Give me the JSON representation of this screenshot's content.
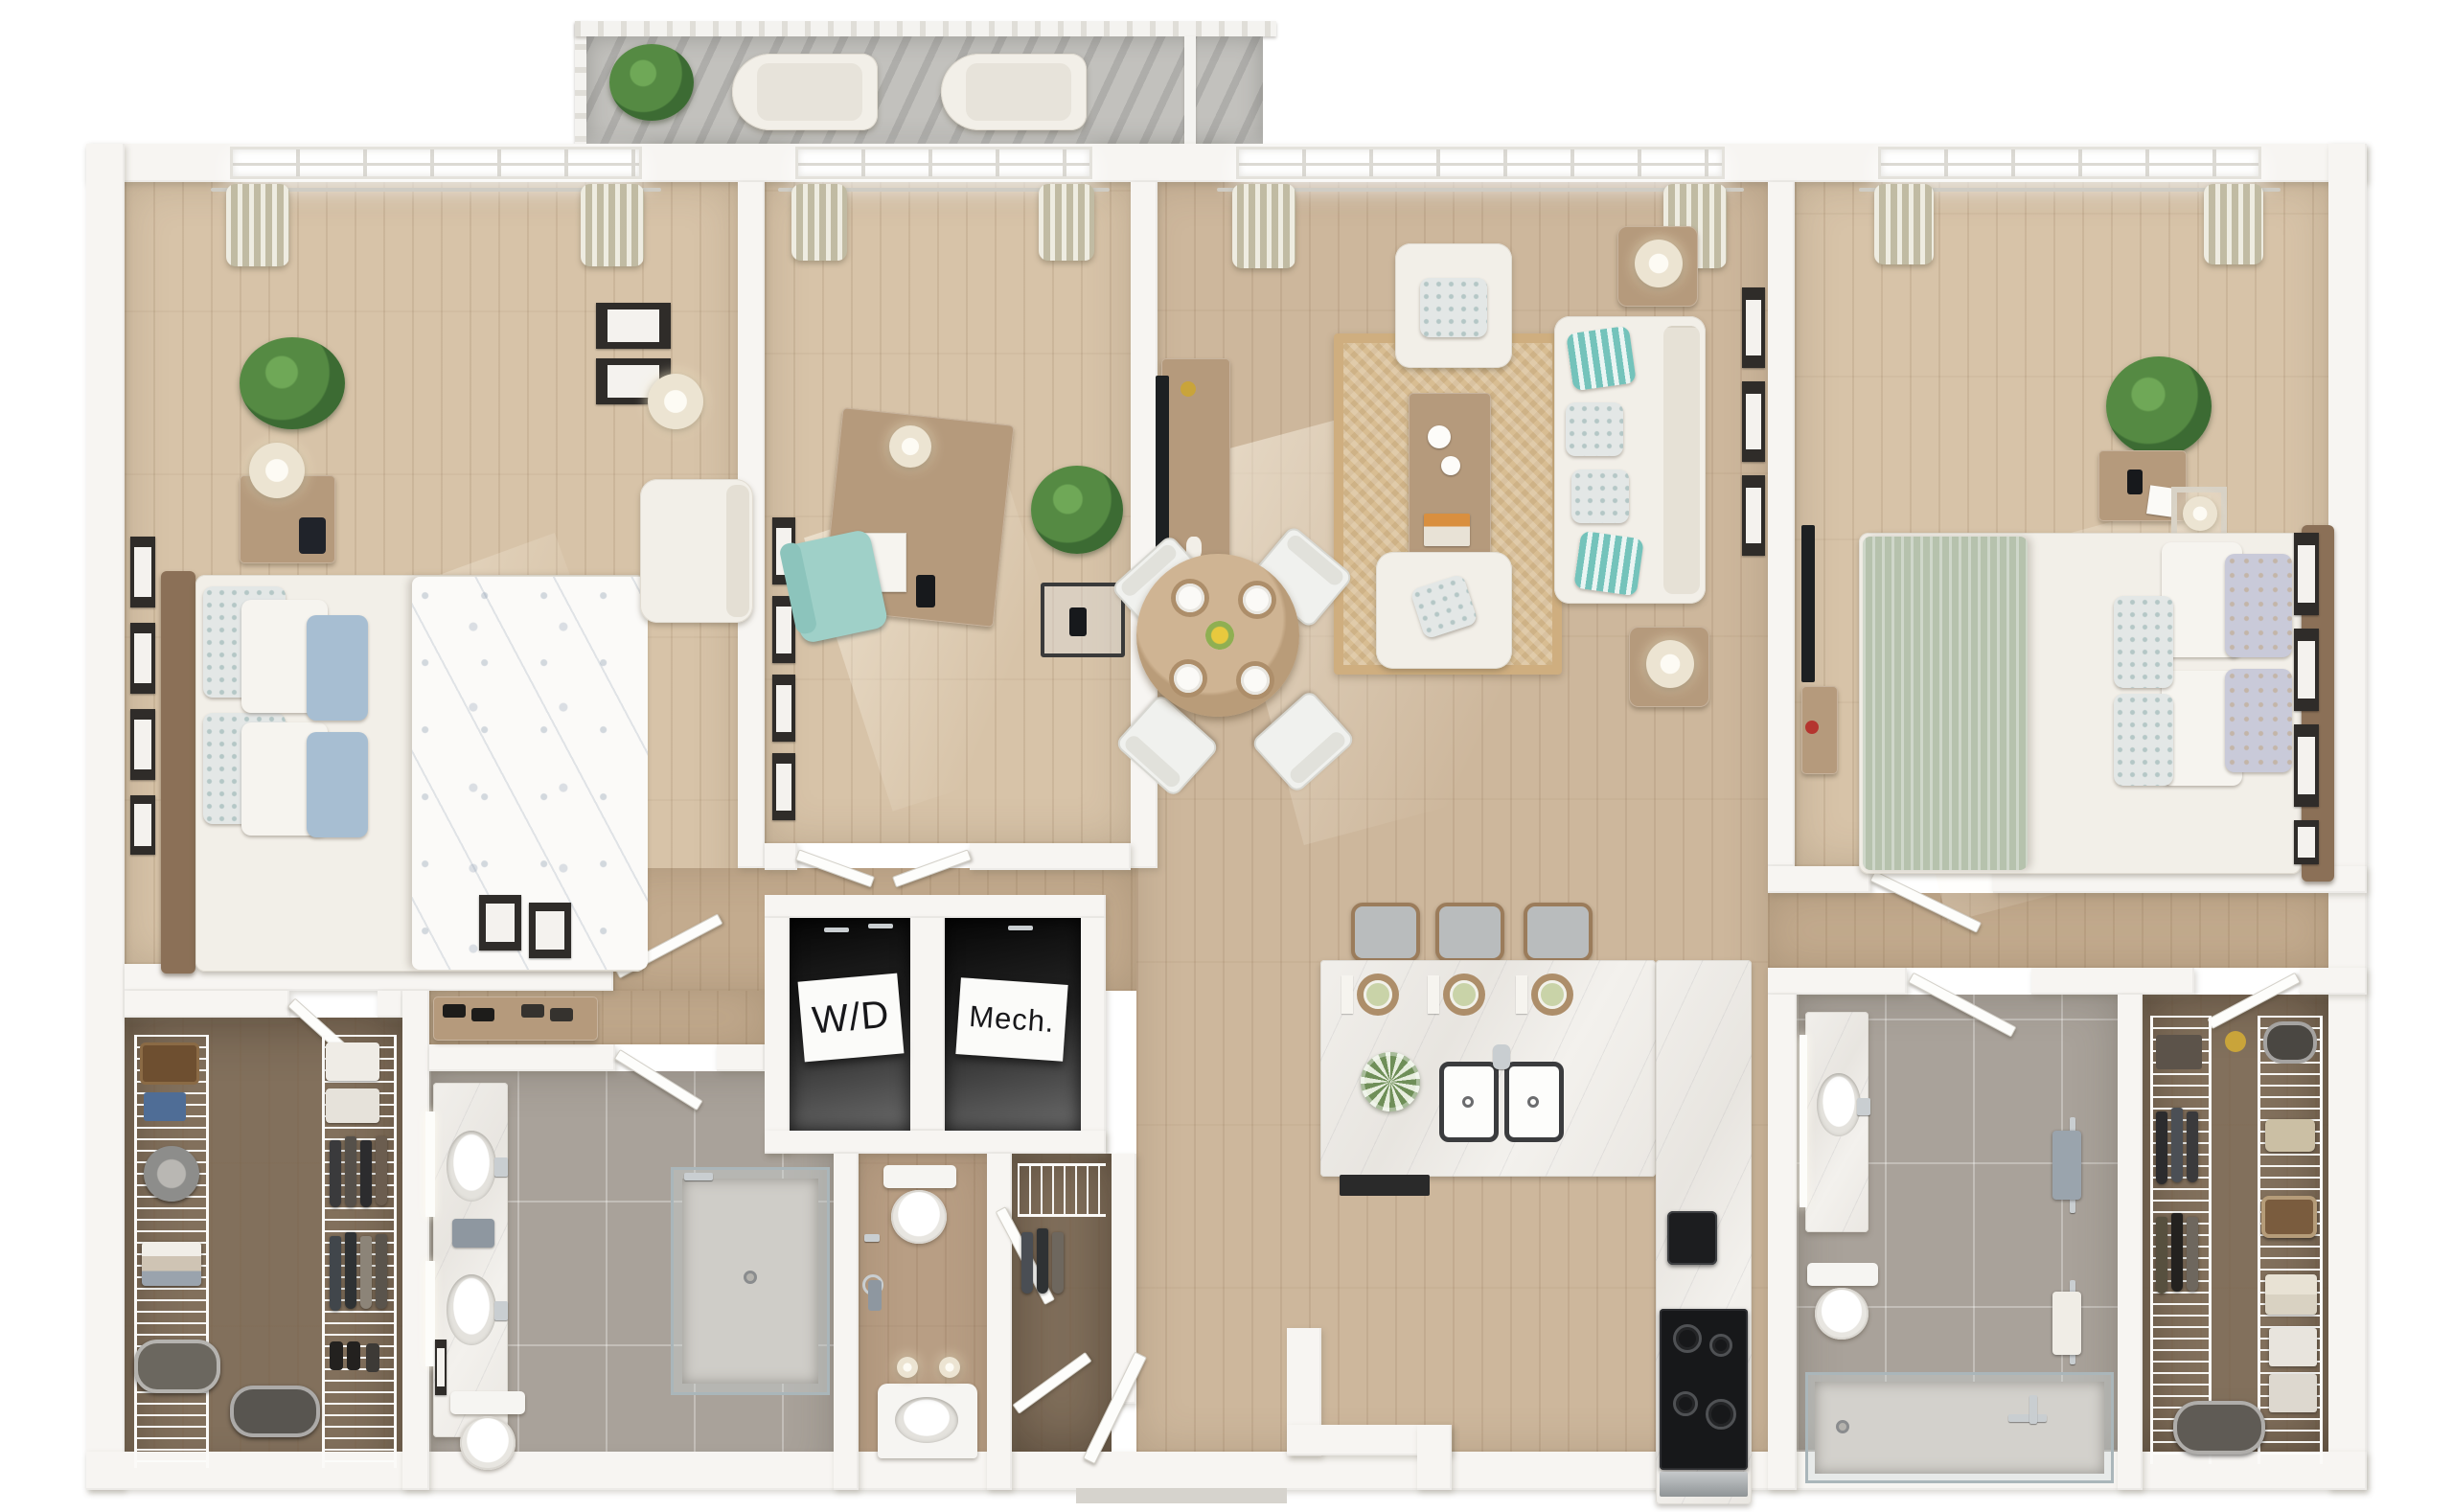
{
  "labels": {
    "wd": "W/D",
    "mech": "Mech."
  },
  "palette": {
    "wall": "#f7f5f2",
    "wood-main": "#cdb79c",
    "wood-bed": "#d7c3a8",
    "wood-hall": "#c3ab8e",
    "wood-dark": "#82705c",
    "wood-powder": "#b89e84",
    "tile": "#a9a29a",
    "marble": "#edebe7",
    "rug": "#d8bd92",
    "cream": "#f2efe8",
    "teal": "#74c3bb",
    "sage": "#b6c2ad",
    "blue": "#a7bed2",
    "curtain": "#d9d4bd",
    "wood-furn": "#b59a7c",
    "wood-head": "#8b7057",
    "shade": "#ece4d2",
    "chrome": "#c9ced1",
    "dark": "#1d2022",
    "concrete": "#c2c1bd"
  }
}
